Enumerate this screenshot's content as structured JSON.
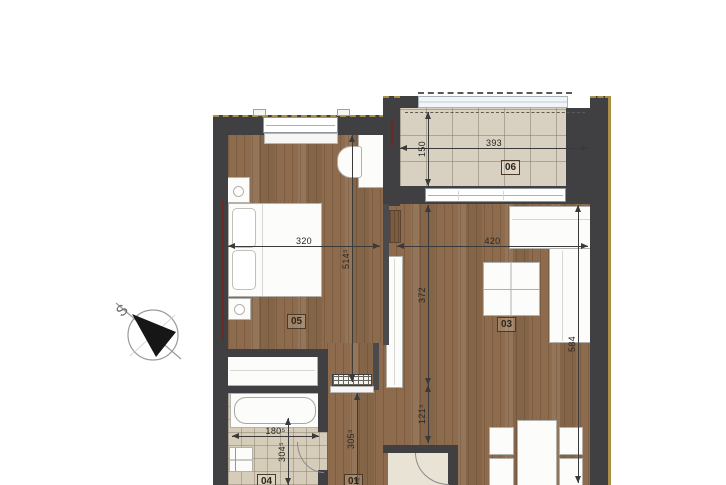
{
  "compass": {
    "north_label": "S"
  },
  "rooms": {
    "hall": {
      "number": "01",
      "depth": "305⁵"
    },
    "living": {
      "number": "03",
      "width": "420",
      "depth_total": "584",
      "depth_to_hall": "372",
      "opening": "121⁵"
    },
    "bathroom": {
      "number": "04",
      "width": "180⁵",
      "depth": "304⁵"
    },
    "bedroom": {
      "number": "05",
      "width": "320",
      "depth": "514⁵"
    },
    "balcony": {
      "number": "06",
      "width": "393",
      "depth": "150"
    }
  },
  "colors": {
    "wall": "#403f42",
    "wood_floor": "#8d6b4c",
    "tile_floor": "#d8d0c1",
    "exterior_outline": "#a89048",
    "dimension_line": "#3a3a3a"
  }
}
